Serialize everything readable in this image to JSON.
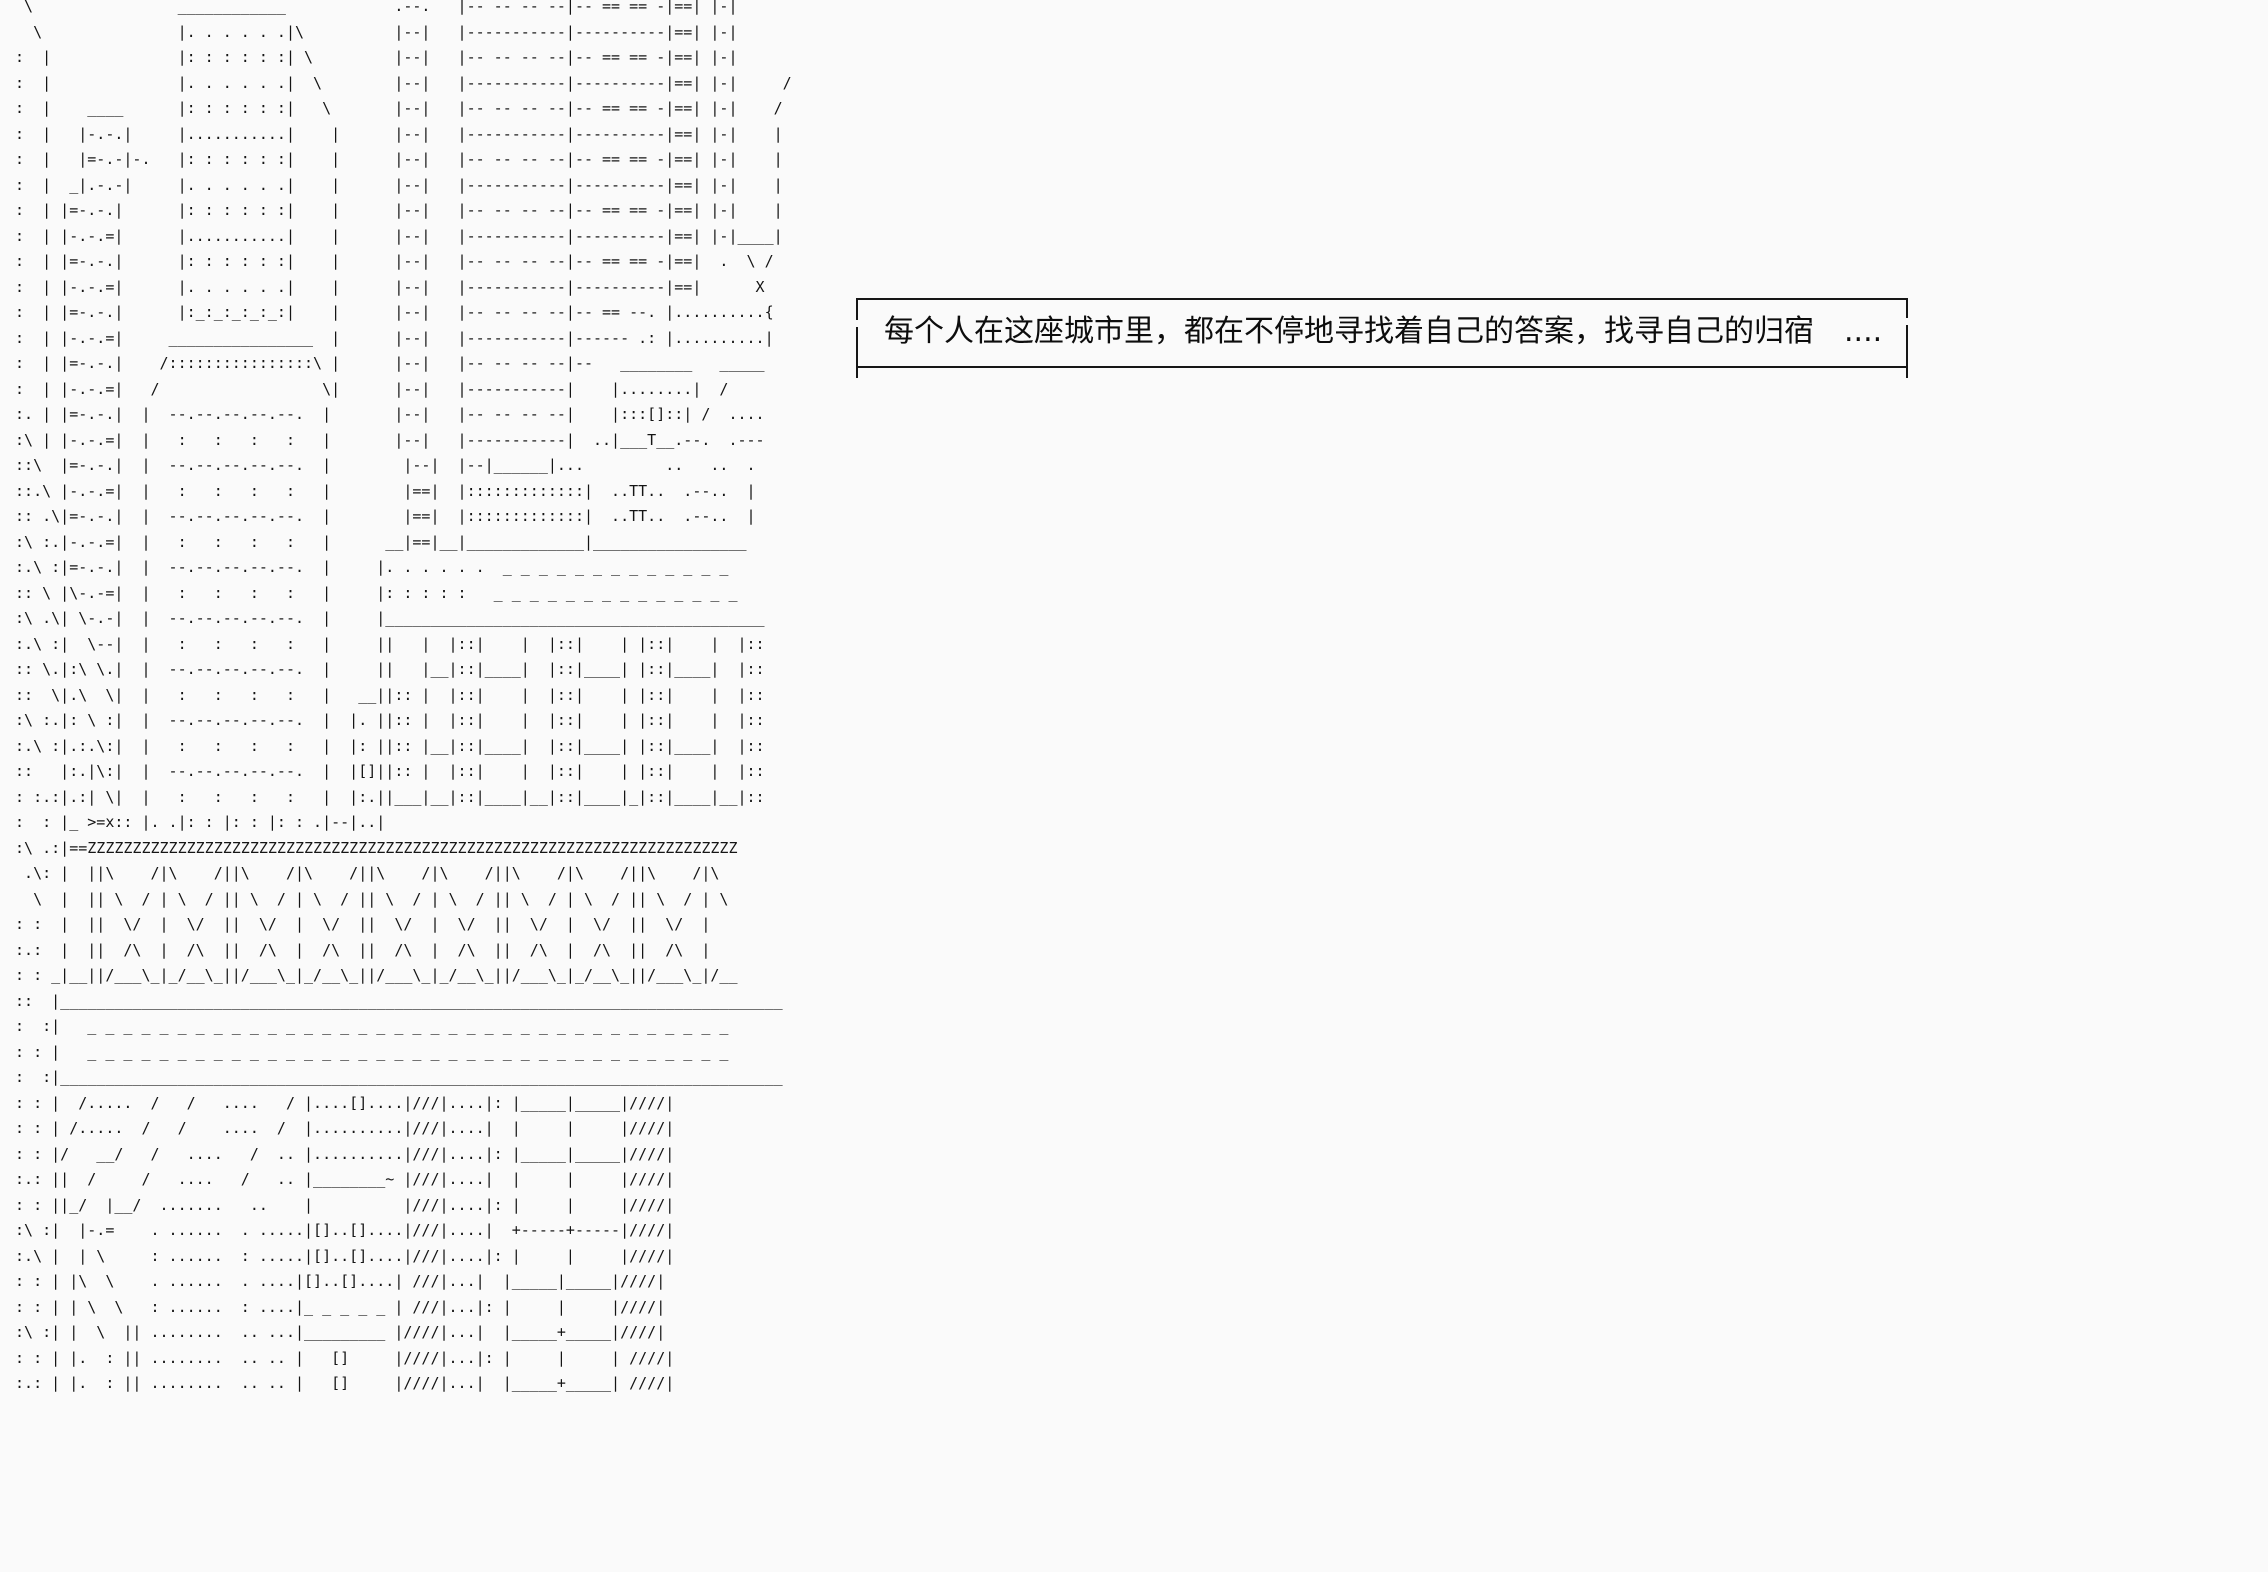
{
  "colors": {
    "background": "#fafafa",
    "ink": "#161616"
  },
  "dialogue": {
    "text": "每个人在这座城市里，都在不停地寻找着自己的答案，找寻自己的归宿　...."
  },
  "ascii_art": {
    "lines": [
      "  \\                ____________            .--.   |-- -- -- --|-- == == -|==| |-|",
      "   \\               |. . . . . .|\\          |--|   |-----------|----------|==| |-|",
      " :  |              |: : : : : :| \\         |--|   |-- -- -- --|-- == == -|==| |-|",
      " :  |              |. . . . . .|  \\        |--|   |-----------|----------|==| |-|     /",
      " :  |    ____      |: : : : : :|   \\       |--|   |-- -- -- --|-- == == -|==| |-|    /",
      " :  |   |-.-.|     |...........|    |      |--|   |-----------|----------|==| |-|    |",
      " :  |   |=-.-|-.   |: : : : : :|    |      |--|   |-- -- -- --|-- == == -|==| |-|    |",
      " :  |  _|.-.-|     |. . . . . .|    |      |--|   |-----------|----------|==| |-|    |",
      " :  | |=-.-.|      |: : : : : :|    |      |--|   |-- -- -- --|-- == == -|==| |-|    |",
      " :  | |-.-.=|      |...........|    |      |--|   |-----------|----------|==| |-|____|",
      " :  | |=-.-.|      |: : : : : :|    |      |--|   |-- -- -- --|-- == == -|==|  .  \\ /",
      " :  | |-.-.=|      |. . . . . .|    |      |--|   |-----------|----------|==|      X",
      " :  | |=-.-.|      |:_:_:_:_:_:|    |      |--|   |-- -- -- --|-- == --. |..........{",
      " :  | |-.-.=|     ________________  |      |--|   |-----------|------ .: |..........|",
      " :  | |=-.-.|    /::::::::::::::::\\ |      |--|   |-- -- -- --|--   ________   _____",
      " :  | |-.-.=|   /                  \\|      |--|   |-----------|    |........|  /",
      " :. | |=-.-.|  |  --.--.--.--.--.  |       |--|   |-- -- -- --|    |:::[]::| /  ....",
      " :\\ | |-.-.=|  |   :   :   :   :   |       |--|   |-----------|  ..|___T__.--.  .---",
      " ::\\  |=-.-.|  |  --.--.--.--.--.  |        |--|  |--|______|...         ..   ..  .",
      " ::.\\ |-.-.=|  |   :   :   :   :   |        |==|  |:::::::::::::|  ..TT..  .--..  |",
      " :: .\\|=-.-.|  |  --.--.--.--.--.  |        |==|  |:::::::::::::|  ..TT..  .--..  |",
      " :\\ :.|-.-.=|  |   :   :   :   :   |      __|==|__|_____________|_________________",
      " :.\\ :|=-.-.|  |  --.--.--.--.--.  |     |. . . . . .  _ _ _ _ _ _ _ _ _ _ _ _ _",
      " :: \\ |\\-.-=|  |   :   :   :   :   |     |: : : : :   _ _ _ _ _ _ _ _ _ _ _ _ _ _",
      " :\\ .\\| \\-.-|  |  --.--.--.--.--.  |     |__________________________________________",
      " :.\\ :|  \\--|  |   :   :   :   :   |     ||   |  |::|    |  |::|    | |::|    |  |::",
      " :: \\.|:\\ \\.|  |  --.--.--.--.--.  |     ||   |__|::|____|  |::|____| |::|____|  |::",
      " ::  \\|.\\  \\|  |   :   :   :   :   |   __||:: |  |::|    |  |::|    | |::|    |  |::",
      " :\\ :.|: \\ :|  |  --.--.--.--.--.  |  |. ||:: |  |::|    |  |::|    | |::|    |  |::",
      " :.\\ :|.:.\\:|  |   :   :   :   :   |  |: ||:: |__|::|____|  |::|____| |::|____|  |::",
      " ::   |:.|\\:|  |  --.--.--.--.--.  |  |[]||:: |  |::|    |  |::|    | |::|    |  |::",
      " : :.:|.:| \\|  |   :   :   :   :   |  |:.||___|__|::|____|__|::|____|_|::|____|__|::",
      " :  : |_ >=x:: |. .|: : |: : |: : .|--|..|",
      " :\\ .:|==ZZZZZZZZZZZZZZZZZZZZZZZZZZZZZZZZZZZZZZZZZZZZZZZZZZZZZZZZZZZZZZZZZZZZZZZZ",
      "  .\\: |  ||\\    /|\\    /||\\    /|\\    /||\\    /|\\    /||\\    /|\\    /||\\    /|\\",
      "   \\  |  || \\  / | \\  / || \\  / | \\  / || \\  / | \\  / || \\  / | \\  / || \\  / | \\",
      " : :  |  ||  \\/  |  \\/  ||  \\/  |  \\/  ||  \\/  |  \\/  ||  \\/  |  \\/  ||  \\/  |",
      " :.:  |  ||  /\\  |  /\\  ||  /\\  |  /\\  ||  /\\  |  /\\  ||  /\\  |  /\\  ||  /\\  |",
      " : : _|__||/___\\_|_/__\\_||/___\\_|_/__\\_||/___\\_|_/__\\_||/___\\_|_/__\\_||/___\\_|/__",
      " ::  |________________________________________________________________________________",
      " :  :|   _ _ _ _ _ _ _ _ _ _ _ _ _ _ _ _ _ _ _ _ _ _ _ _ _ _ _ _ _ _ _ _ _ _ _ _",
      " : : |   _ _ _ _ _ _ _ _ _ _ _ _ _ _ _ _ _ _ _ _ _ _ _ _ _ _ _ _ _ _ _ _ _ _ _ _",
      " :  :|________________________________________________________________________________",
      " : : |  /.....  /   /   ....   / |....[]....|///|....|: |_____|_____|////|",
      " : : | /.....  /   /    ....  /  |..........|///|....|  |     |     |////|",
      " : : |/   __/   /   ....   /  .. |..........|///|....|: |_____|_____|////|",
      " :.: ||  /     /   ....   /   .. |________~ |///|....|  |     |     |////|",
      " : : ||_/  |__/  .......   ..    |          |///|....|: |     |     |////|",
      " :\\ :|  |-.=    . ......  . .....|[]..[]....|///|....|  +-----+-----|////|",
      " :.\\ |  | \\     : ......  : .....|[]..[]....|///|....|: |     |     |////|",
      " : : | |\\  \\    . ......  . ....|[]..[]....| ///|...|  |_____|_____|////|",
      " : : | | \\  \\   : ......  : ....|_ _ _ _ _ | ///|...|: |     |     |////|",
      " :\\ :| |  \\  || ........  .. ...|_________ |////|...|  |_____+_____|////|",
      " : : | |.  : || ........  .. .. |   []     |////|...|: |     |     | ////|",
      " :.: | |.  : || ........  .. .. |   []     |////|...|  |_____+_____| ////|"
    ]
  }
}
